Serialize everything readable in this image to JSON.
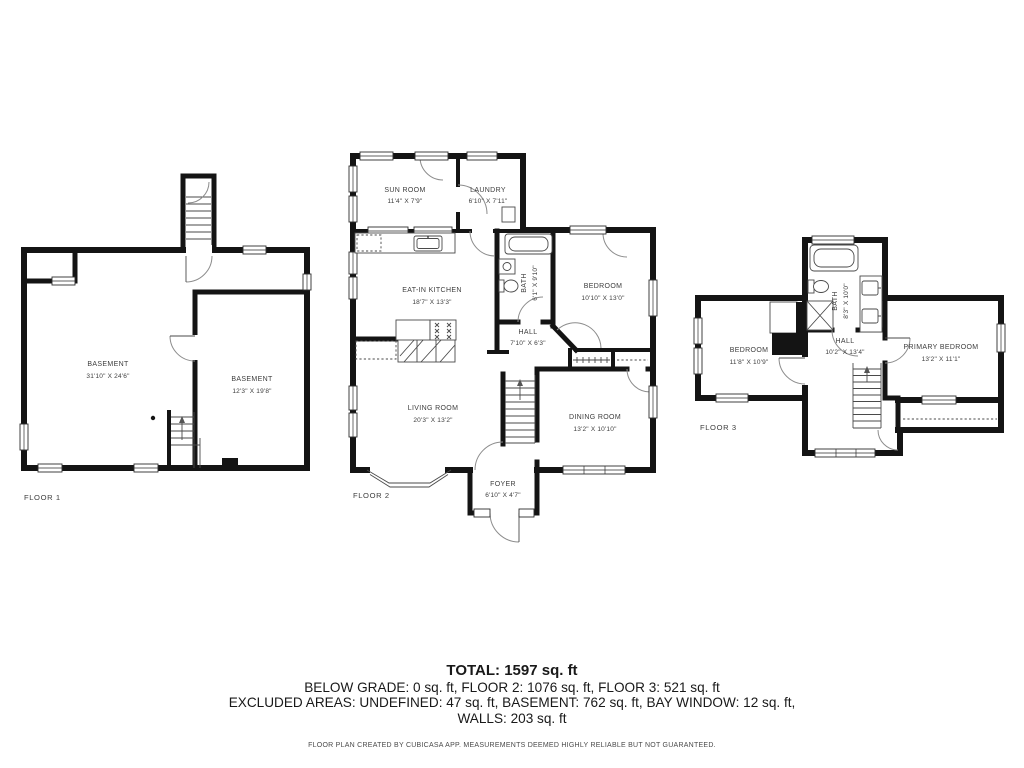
{
  "colors": {
    "wall": "#141414",
    "text": "#3d3d3d",
    "background": "#ffffff"
  },
  "floors": [
    {
      "label": "FLOOR 1",
      "rooms": [
        {
          "name": "BASEMENT",
          "dims": "31'10\" X 24'6\""
        },
        {
          "name": "BASEMENT",
          "dims": "12'3\" X 19'8\""
        }
      ]
    },
    {
      "label": "FLOOR 2",
      "rooms": [
        {
          "name": "SUN ROOM",
          "dims": "11'4\" X 7'9\""
        },
        {
          "name": "LAUNDRY",
          "dims": "6'10\" X 7'11\""
        },
        {
          "name": "EAT-IN KITCHEN",
          "dims": "18'7\" X 13'3\""
        },
        {
          "name": "BATH",
          "dims": "6'1\" X 9'10\""
        },
        {
          "name": "BEDROOM",
          "dims": "10'10\" X 13'0\""
        },
        {
          "name": "HALL",
          "dims": "7'10\" X 6'3\""
        },
        {
          "name": "LIVING ROOM",
          "dims": "20'3\" X 13'2\""
        },
        {
          "name": "DINING ROOM",
          "dims": "13'2\" X 10'10\""
        },
        {
          "name": "FOYER",
          "dims": "6'10\" X 4'7\""
        }
      ]
    },
    {
      "label": "FLOOR 3",
      "rooms": [
        {
          "name": "BEDROOM",
          "dims": "11'8\" X 10'9\""
        },
        {
          "name": "BATH",
          "dims": "8'3\" X 10'0\""
        },
        {
          "name": "HALL",
          "dims": "10'2\" X 13'4\""
        },
        {
          "name": "PRIMARY BEDROOM",
          "dims": "13'2\" X 11'1\""
        }
      ]
    }
  ],
  "summary": {
    "total": "TOTAL: 1597 sq. ft",
    "line1": "BELOW GRADE: 0 sq. ft, FLOOR 2: 1076 sq. ft, FLOOR 3: 521 sq. ft",
    "line2": "EXCLUDED AREAS: UNDEFINED: 47 sq. ft, BASEMENT: 762 sq. ft, BAY WINDOW: 12 sq. ft,",
    "line3": "WALLS: 203 sq. ft"
  },
  "footer": {
    "disclaimer": "FLOOR PLAN CREATED BY CUBICASA APP. MEASUREMENTS DEEMED HIGHLY RELIABLE BUT NOT GUARANTEED."
  }
}
